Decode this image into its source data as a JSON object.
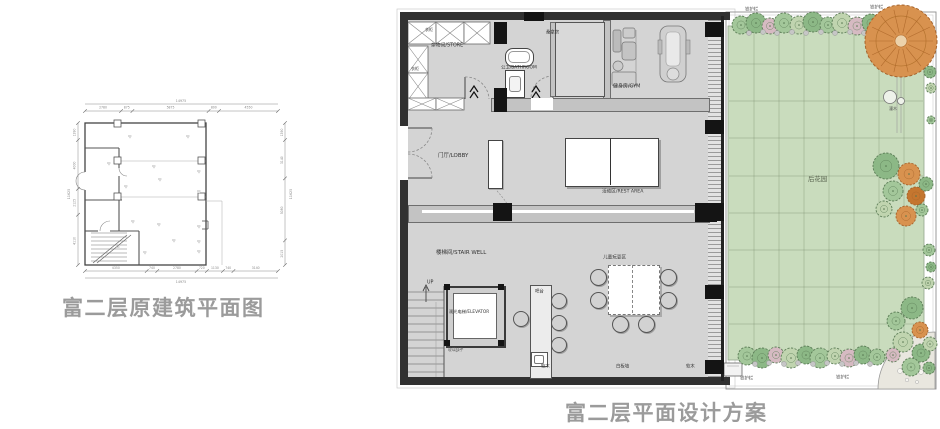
{
  "left_plan": {
    "title": "富二层原建筑平面图",
    "dimensions": {
      "top_total": "14975",
      "top_segments": [
        "2780",
        "875",
        "5875",
        "800",
        "4550"
      ],
      "bottom_segments": [
        "4350",
        "740",
        "2780",
        "720",
        "1130",
        "740",
        "3140"
      ],
      "bottom_total": "14975",
      "left_segments": [
        "1390",
        "4000",
        "2125",
        "4110"
      ],
      "left_total": "11625",
      "right_segments": [
        "1390",
        "3140",
        "5080",
        "2015"
      ],
      "right_total": "11625"
    }
  },
  "right_plan": {
    "title": "富二层平面设计方案",
    "rooms": {
      "storage": "杂物间/STORE",
      "wardrobe_top": "衣柜",
      "wardrobe_left": "衣柜",
      "bathroom": "公卫/BATHROOM",
      "sauna": "桑拿房",
      "gym": "健身房/GYM",
      "lobby": "门厅/LOBBY",
      "rest_area": "活动区/REST AREA",
      "stair_well": "楼梯间/STAIR WELL",
      "up": "UP",
      "elevator": "观光电梯/ELEVATOR",
      "glass_note": "玻璃扶手",
      "bar": "吧台",
      "kids_area": "儿童玩耍区",
      "cork_left": "软木",
      "whiteboard": "白板墙",
      "cork_right": "软木"
    },
    "garden": {
      "name": "后花园",
      "fence_top_left": "铁护栏",
      "fence_top_right": "铁护栏",
      "fence_bottom_left": "铁护栏",
      "fence_bottom_right": "铁护栏",
      "shrub": "灌木"
    }
  },
  "colors": {
    "title": "#9b9b9b",
    "wall": "#313131",
    "floor": "#d4d4d4",
    "lawn": "#c9dcbd",
    "tree_green": "#8cb886",
    "tree_orange": "#d8924f"
  }
}
